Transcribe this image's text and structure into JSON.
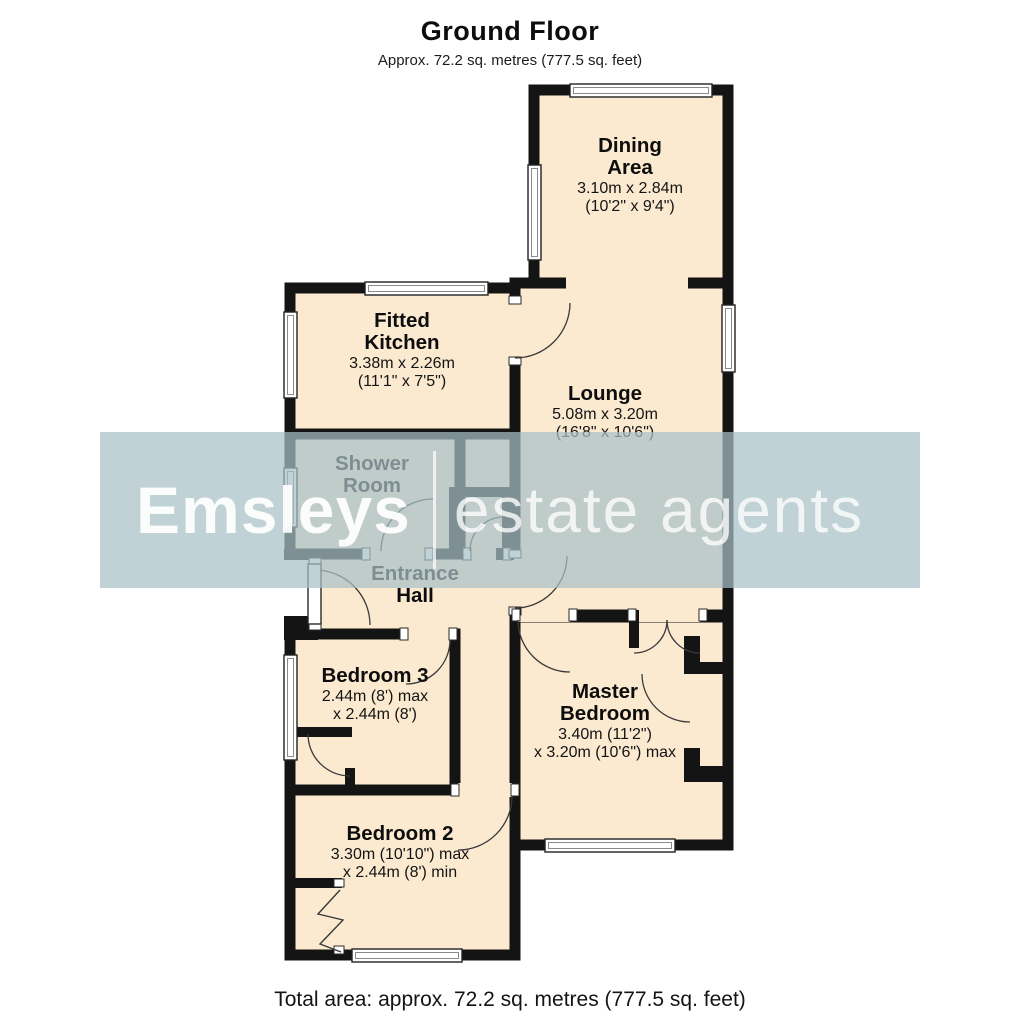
{
  "header": {
    "title": "Ground Floor",
    "subtitle": "Approx. 72.2 sq. metres (777.5 sq. feet)"
  },
  "footer": {
    "total_area": "Total area: approx. 72.2 sq. metres (777.5 sq. feet)"
  },
  "watermark": {
    "brand": "Emsleys",
    "suffix": "estate agents"
  },
  "rooms": [
    {
      "id": "dining",
      "name_lines": [
        "Dining",
        "Area"
      ],
      "dim_lines": [
        "3.10m x 2.84m",
        "(10'2\" x 9'4\")"
      ]
    },
    {
      "id": "kitchen",
      "name_lines": [
        "Fitted",
        "Kitchen"
      ],
      "dim_lines": [
        "3.38m x 2.26m",
        "(11'1\" x 7'5\")"
      ]
    },
    {
      "id": "lounge",
      "name_lines": [
        "Lounge"
      ],
      "dim_lines": [
        "5.08m x 3.20m",
        "(16'8\" x 10'6\")"
      ]
    },
    {
      "id": "shower",
      "name_lines": [
        "Shower",
        "Room"
      ],
      "dim_lines": []
    },
    {
      "id": "hall",
      "name_lines": [
        "Entrance",
        "Hall"
      ],
      "dim_lines": []
    },
    {
      "id": "bed3",
      "name_lines": [
        "Bedroom 3"
      ],
      "dim_lines": [
        "2.44m (8') max",
        "x 2.44m (8')"
      ]
    },
    {
      "id": "master",
      "name_lines": [
        "Master",
        "Bedroom"
      ],
      "dim_lines": [
        "3.40m (11'2\")",
        "x 3.20m (10'6\") max"
      ]
    },
    {
      "id": "bed2",
      "name_lines": [
        "Bedroom 2"
      ],
      "dim_lines": [
        "3.30m (10'10\") max",
        "x 2.44m (8') min"
      ]
    }
  ],
  "colors": {
    "background": "#ffffff",
    "room_fill": "#fbead0",
    "wall": "#141414",
    "window_frame": "#222222",
    "door_arc": "#3a3a3a",
    "watermark_band": "#a7c0c6",
    "watermark_text": "#ffffff"
  }
}
